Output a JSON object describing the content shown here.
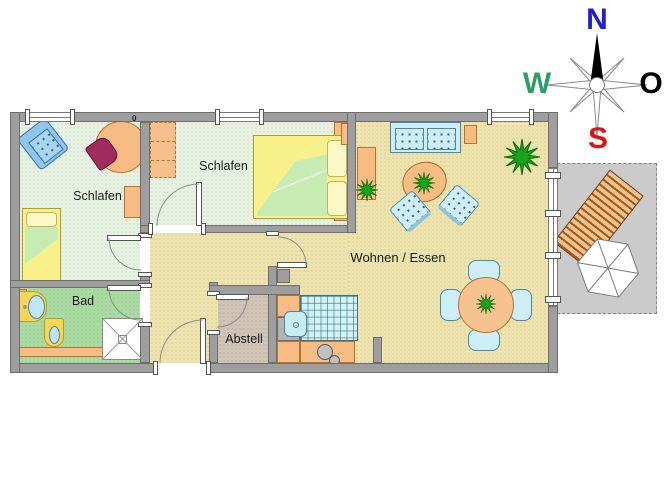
{
  "title": "Apartment floor plan",
  "level_marker": "0",
  "compass": {
    "north": {
      "label": "N",
      "color": "#1f1fd6"
    },
    "east": {
      "label": "O",
      "color": "#000000"
    },
    "south": {
      "label": "S",
      "color": "#e01010"
    },
    "west": {
      "label": "W",
      "color": "#2e9e63"
    }
  },
  "rooms": {
    "bedroom1": {
      "label": "Schlafen",
      "furniture": [
        "single-bed",
        "armchair",
        "side-chair",
        "round-table",
        "desk"
      ]
    },
    "bedroom2": {
      "label": "Schlafen",
      "furniture": [
        "double-bed",
        "wardrobe",
        "nightstand",
        "nightstand"
      ]
    },
    "bath": {
      "label": "Bad",
      "fixtures": [
        "washbasin",
        "toilet",
        "shower",
        "bench"
      ]
    },
    "storage": {
      "label": "Abstell"
    },
    "living": {
      "label": "Wohnen / Essen",
      "furniture": [
        "sofa",
        "side-table",
        "side-table",
        "sideboard",
        "coffee-table",
        "armchair",
        "armchair",
        "potted-plant",
        "potted-plant",
        "potted-plant",
        "dining-table",
        "dining-chair",
        "dining-chair",
        "dining-chair",
        "dining-chair",
        "large-plant"
      ]
    },
    "kitchen": {
      "fixtures": [
        "sink",
        "stove-burners",
        "counter",
        "wall-tiles"
      ]
    },
    "terrace": {
      "furniture": [
        "sun-lounger",
        "parasol"
      ]
    }
  },
  "colors": {
    "wall": "#9e9e9e",
    "bedroom_floor": "#e8f2e3",
    "bath_floor": "#aadba3",
    "living_floor": "#eee3ac",
    "storage_floor": "#cfc4b5",
    "terrace": "#cbcbcb",
    "furniture_orange": "#f6bc84",
    "furniture_blue": "#cdeef7",
    "bed_yellow": "#f8f08a",
    "bedding_green": "#c6ecb4",
    "plant_green": "#1ca21c",
    "chair_maroon": "#a02c5e",
    "lounger_stripe": "#9c5a1a"
  }
}
